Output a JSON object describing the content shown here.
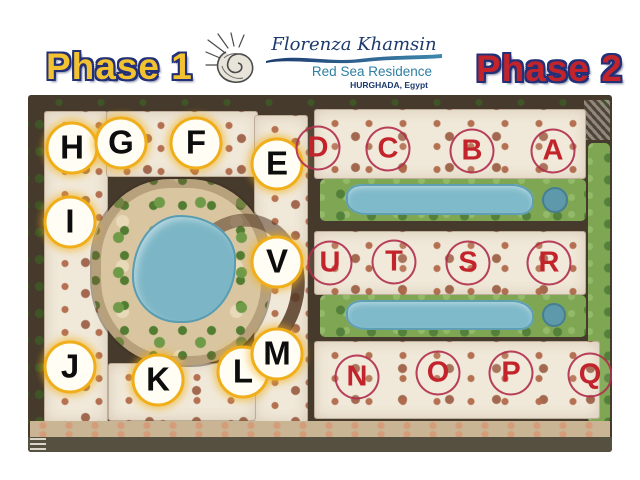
{
  "header": {
    "phase1_label": "Phase 1",
    "phase2_label": "Phase 2",
    "logo": {
      "icon": "seashell-icon",
      "name": "Florenza Khamsin",
      "subtitle": "Red Sea Residence",
      "location": "HURGHADA, Egypt"
    }
  },
  "map": {
    "description": "Master plan site map of Florenza Khamsin resort, birds-eye view",
    "phase1_markers": [
      {
        "letter": "H",
        "x": 44,
        "y": 53
      },
      {
        "letter": "G",
        "x": 93,
        "y": 48
      },
      {
        "letter": "F",
        "x": 168,
        "y": 48
      },
      {
        "letter": "E",
        "x": 249,
        "y": 69
      },
      {
        "letter": "I",
        "x": 42,
        "y": 127
      },
      {
        "letter": "V",
        "x": 249,
        "y": 167
      },
      {
        "letter": "J",
        "x": 42,
        "y": 272
      },
      {
        "letter": "K",
        "x": 130,
        "y": 285
      },
      {
        "letter": "L",
        "x": 215,
        "y": 277
      },
      {
        "letter": "M",
        "x": 249,
        "y": 259
      }
    ],
    "phase2_markers": [
      {
        "letter": "D",
        "x": 290,
        "y": 53
      },
      {
        "letter": "C",
        "x": 360,
        "y": 54
      },
      {
        "letter": "B",
        "x": 444,
        "y": 56
      },
      {
        "letter": "A",
        "x": 525,
        "y": 56
      },
      {
        "letter": "U",
        "x": 302,
        "y": 168
      },
      {
        "letter": "T",
        "x": 366,
        "y": 167
      },
      {
        "letter": "S",
        "x": 440,
        "y": 168
      },
      {
        "letter": "R",
        "x": 521,
        "y": 168
      },
      {
        "letter": "N",
        "x": 329,
        "y": 282
      },
      {
        "letter": "O",
        "x": 410,
        "y": 278
      },
      {
        "letter": "P",
        "x": 483,
        "y": 278
      },
      {
        "letter": "Q",
        "x": 562,
        "y": 280
      }
    ],
    "marker_styles": {
      "phase1": {
        "letter_color": "#0D0D0D",
        "ring_color": "#F0AE1A",
        "fill": "#FFFDF4"
      },
      "phase2": {
        "letter_color": "#C3242C",
        "ring_color": "#B02C4C",
        "fill": "transparent"
      }
    },
    "colors": {
      "phase1_yellow": "#F2C230",
      "phase2_red": "#C3242C",
      "outline_navy": "#233078",
      "logo_navy": "#1D3A6E",
      "logo_teal": "#2E7FA3",
      "map_dark_ground": "#463A2C",
      "building_cream": "#F0E8D8",
      "roof_brown": "#B26A4B",
      "courtyard_sand": "#D9C6A0",
      "lawn_green": "#7FA653",
      "pool_blue": "#7FBACA",
      "beach_tan": "#C9B493"
    }
  }
}
